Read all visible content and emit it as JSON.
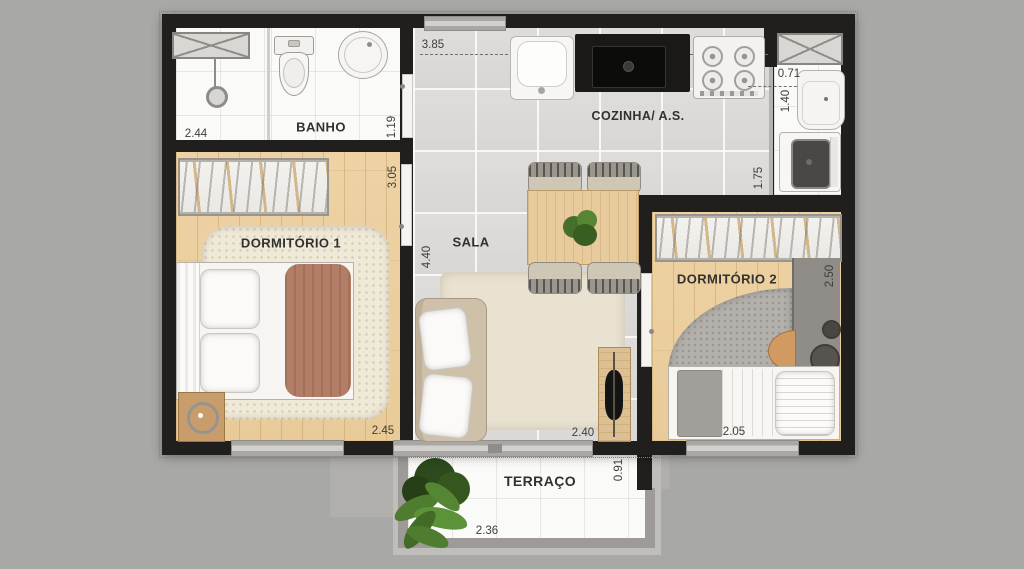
{
  "labels": {
    "banho": "BANHO",
    "cozinha": "COZINHA/ A.S.",
    "dormitorio1": "DORMITÓRIO 1",
    "sala": "SALA",
    "dormitorio2": "DORMITÓRIO 2",
    "terraco": "TERRAÇO"
  },
  "dimensions": {
    "banho_width": "2.44",
    "banho_depth": "1.19",
    "cozinha_width": "3.85",
    "servico_width": "0.71",
    "servico_depth": "1.40",
    "servico_length": "1.75",
    "dorm1_depth": "3.05",
    "dorm1_width": "2.45",
    "sala_depth": "4.40",
    "sala_width": "2.40",
    "dorm2_depth": "2.50",
    "dorm2_width": "2.05",
    "terraco_depth": "0.91",
    "terraco_width": "2.36"
  },
  "palette": {
    "background": "#a8a8a6",
    "walls": "#211f1d",
    "wood_floor": "#ecd0a2",
    "tile_floor": "#d9d8d6",
    "white_floor": "#fafaf9",
    "accent_terracotta": "#b27e68",
    "plant_green": "#4e7d2f",
    "railing_gray": "#9d9a97"
  }
}
